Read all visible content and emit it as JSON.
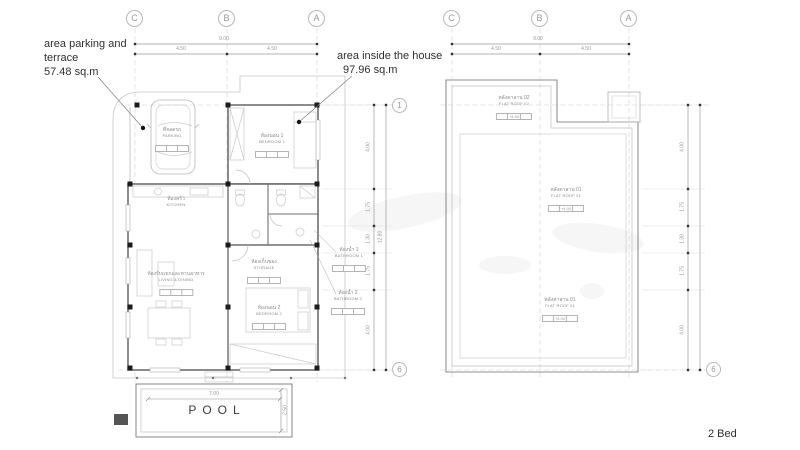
{
  "annotations": {
    "parking": {
      "line1": "area parking and",
      "line2": "terrace",
      "value": "57.48 sq.m"
    },
    "inside": {
      "line1": "area inside the house",
      "value": "97.96 sq.m"
    },
    "bed_count": "2 Bed"
  },
  "floor_plan": {
    "grid": {
      "col_c": "C",
      "col_b": "B",
      "col_a": "A",
      "row_1": "1",
      "row_6": "6"
    },
    "dim_top": {
      "overall": "9.00",
      "seg_left": "4.50",
      "seg_right": "4.50"
    },
    "dim_right": {
      "overall": "12.80",
      "segments": [
        "4.00",
        "1.75",
        "1.30",
        "1.75",
        "4.00"
      ]
    },
    "rooms": {
      "parking": {
        "th": "ที่จอดรถ",
        "en": "PARKING"
      },
      "bedroom1": {
        "th": "ห้องนอน 1",
        "en": "BEDROOM 1"
      },
      "kitchen": {
        "th": "ห้องครัว",
        "en": "KITCHEN"
      },
      "living": {
        "th": "ห้องรับแขกและทานอาหาร",
        "en": "LIVING & DINING"
      },
      "storage": {
        "th": "ห้องเก็บของ",
        "en": "STORAGE"
      },
      "bedroom2": {
        "th": "ห้องนอน 2",
        "en": "BEDROOM 2"
      },
      "bathroom1": {
        "th": "ห้องน้ำ 1",
        "en": "BATHROOM 1"
      },
      "bathroom2": {
        "th": "ห้องน้ำ 2",
        "en": "BATHROOM 2"
      }
    },
    "pool": {
      "label": "POOL",
      "width": "7.00",
      "depth": "2.50"
    }
  },
  "roof_plan": {
    "grid": {
      "col_c": "C",
      "col_b": "B",
      "col_a": "A",
      "row_6": "6"
    },
    "dim_top": {
      "overall": "9.00",
      "seg_left": "4.50",
      "seg_right": "4.50"
    },
    "dim_right": {
      "segments": [
        "4.00",
        "1.75",
        "1.30",
        "1.75",
        "4.00"
      ]
    },
    "labels": {
      "flat_roof_02": {
        "th": "หลังคาลาน 02",
        "en": "FLAT ROOF 02",
        "level": "+4.50"
      },
      "flat_roof_01_upper": {
        "th": "หลังคาลาน 01",
        "en": "FLAT ROOF 01",
        "level": "+4.00"
      },
      "flat_roof_01_lower": {
        "th": "หลังคาลาน 01",
        "en": "FLAT ROOF 01",
        "level": "+4.00"
      }
    }
  },
  "colors": {
    "wall": "#6f6f6f",
    "line_light": "#c8c8c8",
    "dim_text": "#999999",
    "text_dark": "#2f2f2f"
  }
}
